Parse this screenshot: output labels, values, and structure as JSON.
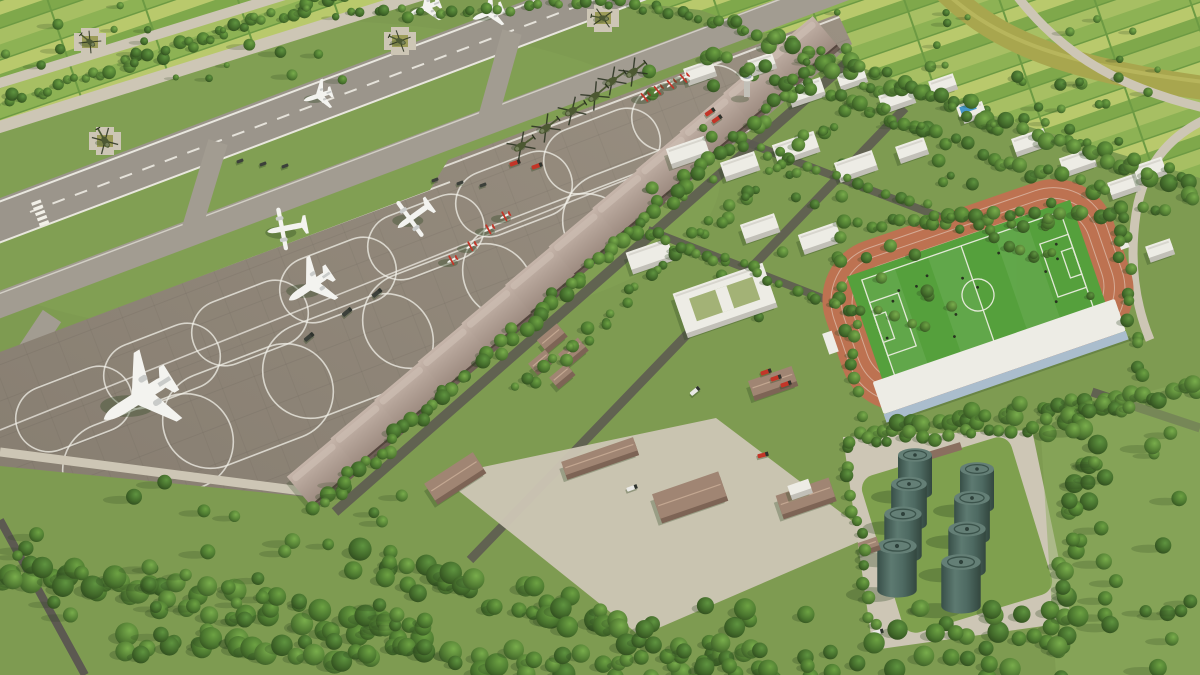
{
  "meta": {
    "description": "Aerial 3D architectural rendering of a military airbase masterplan with runway, apron, hangars, campus buildings, sports stadium and fuel tank farm",
    "visible_text": "none"
  },
  "palette": {
    "grass": "#7e9b51",
    "grass-light": "#8cab5d",
    "farm-mid": "#9ab85e",
    "farm-light": "#c6cf78",
    "farm-dark": "#6d9а43",
    "farm-dark-safe": "#6d9a43",
    "canal": "#a8a64e",
    "road-light": "#cdc6b5",
    "road-dark": "#8b867b",
    "asphalt": "#5c5951",
    "runway": "#9b958b",
    "taxiway": "#a29c91",
    "apron": "#8f8679",
    "marking": "#f2f0e8",
    "pad-olive": "#9c9c58",
    "bld-white": "#edece5",
    "bld-wall": "#c2c0b8",
    "shed-roof": "#a08573",
    "shed-dark": "#7d6455",
    "hangar-roof": "#b2a196",
    "hangar-roof-hi": "#c6b5aa",
    "hangar-face": "#6e5e55",
    "pool": "#4597c9",
    "track": "#bd7251",
    "pitch": "#55a03c",
    "stand-seats": "#aabdcd",
    "tree-dark": "#33511f",
    "tree-mid": "#47702f",
    "tree-light": "#69a041",
    "tree-shadow": "#2c4420",
    "vehicle-dark": "#3c403a",
    "vehicle-white": "#e9e9e6",
    "fire-red": "#c23528",
    "plane-white": "#f3f3ef",
    "plane-gray": "#c9cbc9",
    "heli-olive": "#4c5832",
    "rotor": "#28301e",
    "wall-brown": "#8a6f5f",
    "shadow": "#37412c"
  },
  "scene": {
    "airfield": {
      "runway": {
        "x1": -60,
        "y1": 243,
        "x2": 880,
        "y2": -110,
        "width": 42
      },
      "taxiway": {
        "x1": -60,
        "y1": 327,
        "x2": 900,
        "y2": -33,
        "width": 26
      },
      "connectors": [
        [
          218,
          142,
          192,
          228
        ],
        [
          512,
          32,
          488,
          118
        ],
        [
          52,
          316,
          28,
          352
        ]
      ],
      "apron_polygon": "0,352 430,190 448,160 838,14 852,44 318,498 0,466"
    },
    "parking_rows": [
      {
        "cx0": 690,
        "cy0": 108,
        "dx": -88,
        "dy": 43,
        "n": 8,
        "w": 120,
        "h": 66,
        "rot": -21
      },
      {
        "cx0": 648,
        "cy0": 206,
        "dx": -100,
        "dy": 50,
        "n": 6,
        "w": 176,
        "h": 96,
        "rot": -21
      }
    ],
    "aircraft": [
      {
        "type": "airliner",
        "x": 138,
        "y": 398,
        "rot": -122,
        "s": 2.7
      },
      {
        "type": "jet",
        "x": 310,
        "y": 286,
        "rot": -124,
        "s": 1.7
      },
      {
        "type": "turboprop",
        "x": 287,
        "y": 228,
        "rot": -101,
        "s": 1.55
      },
      {
        "type": "turboprop",
        "x": 414,
        "y": 216,
        "rot": -126,
        "s": 1.55
      },
      {
        "type": "jet",
        "x": 425,
        "y": 8,
        "rot": -112,
        "s": 1.1
      },
      {
        "type": "jet",
        "x": 488,
        "y": 13,
        "rot": -112,
        "s": 1.1
      },
      {
        "type": "jet",
        "x": 318,
        "y": 96,
        "rot": -108,
        "s": 1.0
      },
      {
        "type": "trainer",
        "x": 505,
        "y": 216,
        "rot": -118,
        "s": 1.0
      },
      {
        "type": "trainer",
        "x": 489,
        "y": 229,
        "rot": -118,
        "s": 1.0
      },
      {
        "type": "trainer",
        "x": 471,
        "y": 246,
        "rot": -118,
        "s": 1.0
      },
      {
        "type": "trainer",
        "x": 452,
        "y": 260,
        "rot": -118,
        "s": 1.0
      },
      {
        "type": "trainer",
        "x": 645,
        "y": 97,
        "rot": -130,
        "s": 1.0
      },
      {
        "type": "trainer",
        "x": 658,
        "y": 90,
        "rot": -130,
        "s": 1.0
      },
      {
        "type": "trainer",
        "x": 671,
        "y": 84,
        "rot": -130,
        "s": 1.0
      },
      {
        "type": "trainer",
        "x": 684,
        "y": 78,
        "rot": -130,
        "s": 1.0
      }
    ],
    "helicopters": [
      {
        "x": 633,
        "y": 72,
        "rot": -128,
        "s": 1.3
      },
      {
        "x": 612,
        "y": 81,
        "rot": -125,
        "s": 1.3
      },
      {
        "x": 595,
        "y": 96,
        "rot": -130,
        "s": 1.3
      },
      {
        "x": 572,
        "y": 111,
        "rot": -122,
        "s": 1.3
      },
      {
        "x": 546,
        "y": 128,
        "rot": -128,
        "s": 1.3
      },
      {
        "x": 521,
        "y": 146,
        "rot": -125,
        "s": 1.3
      },
      {
        "x": 105,
        "y": 141,
        "rot": 150,
        "s": 1.2,
        "pad": true
      },
      {
        "x": 400,
        "y": 41,
        "rot": 115,
        "s": 1.0,
        "pad": true
      },
      {
        "x": 603,
        "y": 18,
        "rot": 100,
        "s": 1.0,
        "pad": true
      },
      {
        "x": 90,
        "y": 42,
        "rot": 130,
        "s": 1.0,
        "pad": true
      }
    ],
    "vehicles": [
      {
        "kind": "car",
        "x": 240,
        "y": 161,
        "rot": -20
      },
      {
        "kind": "car",
        "x": 263,
        "y": 164,
        "rot": -20
      },
      {
        "kind": "car",
        "x": 285,
        "y": 166,
        "rot": -20
      },
      {
        "kind": "car",
        "x": 435,
        "y": 180,
        "rot": -20
      },
      {
        "kind": "car",
        "x": 460,
        "y": 183,
        "rot": -20
      },
      {
        "kind": "car",
        "x": 483,
        "y": 185,
        "rot": -20
      },
      {
        "kind": "truck-dark",
        "x": 377,
        "y": 293,
        "rot": -40
      },
      {
        "kind": "truck-dark",
        "x": 347,
        "y": 312,
        "rot": -40
      },
      {
        "kind": "truck-dark",
        "x": 309,
        "y": 337,
        "rot": -40
      },
      {
        "kind": "fire-truck",
        "x": 515,
        "y": 163,
        "rot": -20
      },
      {
        "kind": "fire-truck",
        "x": 537,
        "y": 166,
        "rot": -20
      },
      {
        "kind": "fire-truck",
        "x": 710,
        "y": 112,
        "rot": -35
      },
      {
        "kind": "fire-truck",
        "x": 717,
        "y": 119,
        "rot": -35
      },
      {
        "kind": "fire-truck",
        "x": 763,
        "y": 455,
        "rot": -15
      },
      {
        "kind": "fire-truck",
        "x": 766,
        "y": 372,
        "rot": -19
      },
      {
        "kind": "fire-truck",
        "x": 776,
        "y": 378,
        "rot": -19
      },
      {
        "kind": "fire-truck",
        "x": 786,
        "y": 384,
        "rot": -19
      },
      {
        "kind": "truck-white",
        "x": 695,
        "y": 391,
        "rot": -40
      },
      {
        "kind": "truck-white",
        "x": 632,
        "y": 488,
        "rot": -20
      },
      {
        "kind": "truck-white",
        "x": 878,
        "y": 632,
        "rot": -15
      }
    ],
    "hangar_row": {
      "x1": 802,
      "y1": 50,
      "x2": 322,
      "y2": 472,
      "n": 12,
      "w": 60,
      "h": 38,
      "rot": -40
    },
    "buildings_white": [
      [
        700,
        72,
        30,
        13
      ],
      [
        762,
        64,
        26,
        12
      ],
      [
        806,
        92,
        36,
        15
      ],
      [
        852,
        78,
        28,
        12
      ],
      [
        897,
        99,
        34,
        14
      ],
      [
        943,
        85,
        26,
        12
      ],
      [
        973,
        112,
        24,
        11
      ],
      [
        1030,
        142,
        34,
        14
      ],
      [
        1078,
        162,
        34,
        15
      ],
      [
        1124,
        186,
        30,
        13
      ],
      [
        1160,
        250,
        26,
        12
      ],
      [
        688,
        152,
        40,
        16
      ],
      [
        740,
        166,
        36,
        15
      ],
      [
        796,
        148,
        44,
        17
      ],
      [
        856,
        166,
        40,
        16
      ],
      [
        912,
        150,
        30,
        13
      ],
      [
        650,
        256,
        44,
        18
      ],
      [
        760,
        228,
        36,
        15
      ],
      [
        820,
        238,
        40,
        16
      ],
      [
        725,
        300,
        95,
        42,
        "hq"
      ],
      [
        1150,
        170,
        30,
        14
      ]
    ],
    "control_tower": {
      "x": 747,
      "y": 95
    },
    "pool": {
      "x": 968,
      "y": 108,
      "rot": -19
    },
    "buildings_brown": [
      {
        "x": 552,
        "y": 338,
        "w": 26,
        "h": 12,
        "rot": -40
      },
      {
        "x": 573,
        "y": 352,
        "w": 26,
        "h": 12,
        "rot": -40
      },
      {
        "x": 541,
        "y": 362,
        "w": 22,
        "h": 10,
        "rot": -40
      },
      {
        "x": 562,
        "y": 376,
        "w": 22,
        "h": 10,
        "rot": -40
      },
      {
        "x": 455,
        "y": 478,
        "w": 58,
        "h": 20,
        "rot": -33
      },
      {
        "x": 600,
        "y": 458,
        "w": 76,
        "h": 14,
        "rot": -19
      },
      {
        "x": 690,
        "y": 497,
        "w": 70,
        "h": 26,
        "rot": -19
      },
      {
        "x": 806,
        "y": 498,
        "w": 56,
        "h": 20,
        "rot": -19
      },
      {
        "x": 773,
        "y": 383,
        "w": 46,
        "h": 16,
        "rot": -19
      },
      {
        "x": 869,
        "y": 546,
        "w": 20,
        "h": 9,
        "rot": -19
      },
      {
        "x": 800,
        "y": 489,
        "w": 22,
        "h": 10,
        "rot": -19,
        "kind": "white"
      }
    ],
    "streets": [
      [
        848,
        62,
        335,
        512,
        10
      ],
      [
        905,
        108,
        470,
        560,
        9
      ],
      [
        648,
        230,
        868,
        316,
        8
      ],
      [
        704,
        126,
        1052,
        260,
        8
      ],
      [
        1092,
        392,
        1200,
        428,
        9
      ]
    ],
    "stadium": {
      "cx": 978,
      "cy": 295,
      "rot": -19,
      "track_w": 304,
      "track_h": 176,
      "pitch_w": 210,
      "pitch_h": 104,
      "players": 14
    },
    "fuel_farm": {
      "pad_polygon": "843,437 1032,430 1072,622 873,650",
      "tanks": [
        {
          "x": 915,
          "y": 455,
          "s": 1.0
        },
        {
          "x": 909,
          "y": 484,
          "s": 1.05
        },
        {
          "x": 903,
          "y": 514,
          "s": 1.1
        },
        {
          "x": 897,
          "y": 546,
          "s": 1.16
        },
        {
          "x": 977,
          "y": 469,
          "s": 1.0
        },
        {
          "x": 972,
          "y": 498,
          "s": 1.05
        },
        {
          "x": 967,
          "y": 529,
          "s": 1.1
        },
        {
          "x": 961,
          "y": 562,
          "s": 1.16
        }
      ]
    },
    "vegetation": {
      "belts": [
        {
          "name": "road-a-trees",
          "x1": 0,
          "y1": 104,
          "x2": 345,
          "y2": -6,
          "n": 40,
          "rmin": 4,
          "rmax": 7,
          "j": 6
        },
        {
          "name": "farm-edge-trees",
          "x1": 350,
          "y1": 16,
          "x2": 612,
          "y2": 2,
          "n": 22,
          "rmin": 4,
          "rmax": 6,
          "j": 5
        },
        {
          "name": "hangar-road-west",
          "x1": 842,
          "y1": 48,
          "x2": 318,
          "y2": 506,
          "n": 80,
          "rmin": 5,
          "rmax": 8,
          "j": 6
        },
        {
          "name": "hangar-road-east",
          "x1": 872,
          "y1": 86,
          "x2": 520,
          "y2": 392,
          "n": 45,
          "rmin": 4,
          "rmax": 7,
          "j": 7
        },
        {
          "name": "campus-north-belt",
          "x1": 742,
          "y1": 30,
          "x2": 1200,
          "y2": 190,
          "n": 60,
          "rmin": 5,
          "rmax": 9,
          "j": 9
        },
        {
          "name": "campus-north-belt2",
          "x1": 700,
          "y1": 52,
          "x2": 1160,
          "y2": 214,
          "n": 45,
          "rmin": 5,
          "rmax": 8,
          "j": 8
        },
        {
          "name": "canal-west-belt",
          "x1": 612,
          "y1": 0,
          "x2": 742,
          "y2": 28,
          "n": 14,
          "rmin": 4,
          "rmax": 6,
          "j": 5
        },
        {
          "name": "stadium-north",
          "x1": 846,
          "y1": 226,
          "x2": 1118,
          "y2": 212,
          "n": 26,
          "rmin": 5,
          "rmax": 8,
          "j": 7
        },
        {
          "name": "stadium-south",
          "x1": 860,
          "y1": 430,
          "x2": 1130,
          "y2": 400,
          "n": 30,
          "rmin": 6,
          "rmax": 9,
          "j": 8
        },
        {
          "name": "stadium-west",
          "x1": 836,
          "y1": 238,
          "x2": 858,
          "y2": 412,
          "n": 13,
          "rmin": 5,
          "rmax": 7,
          "j": 6
        },
        {
          "name": "stadium-east",
          "x1": 1118,
          "y1": 216,
          "x2": 1140,
          "y2": 392,
          "n": 13,
          "rmin": 5,
          "rmax": 7,
          "j": 6
        },
        {
          "name": "fuel-west",
          "x1": 846,
          "y1": 448,
          "x2": 872,
          "y2": 628,
          "n": 13,
          "rmin": 5,
          "rmax": 7,
          "j": 5
        },
        {
          "name": "fuel-north",
          "x1": 852,
          "y1": 440,
          "x2": 1036,
          "y2": 430,
          "n": 16,
          "rmin": 5,
          "rmax": 7,
          "j": 5
        },
        {
          "name": "campus-street-1",
          "x1": 648,
          "y1": 232,
          "x2": 864,
          "y2": 316,
          "n": 20,
          "rmin": 4,
          "rmax": 6,
          "j": 6
        },
        {
          "name": "campus-street-2",
          "x1": 704,
          "y1": 128,
          "x2": 1050,
          "y2": 258,
          "n": 28,
          "rmin": 4,
          "rmax": 6,
          "j": 6
        },
        {
          "name": "bottom-forest-1",
          "x1": 0,
          "y1": 568,
          "x2": 440,
          "y2": 636,
          "n": 55,
          "rmin": 7,
          "rmax": 12,
          "j": 16
        },
        {
          "name": "bottom-forest-2",
          "x1": 120,
          "y1": 640,
          "x2": 705,
          "y2": 674,
          "n": 55,
          "rmin": 7,
          "rmax": 12,
          "j": 14
        },
        {
          "name": "bottom-forest-3",
          "x1": 360,
          "y1": 560,
          "x2": 780,
          "y2": 668,
          "n": 55,
          "rmin": 7,
          "rmax": 12,
          "j": 16
        },
        {
          "name": "right-forest-edge",
          "x1": 1052,
          "y1": 672,
          "x2": 1092,
          "y2": 420,
          "n": 26,
          "rmin": 7,
          "rmax": 10,
          "j": 12
        },
        {
          "name": "right-road-belt",
          "x1": 1040,
          "y1": 428,
          "x2": 1200,
          "y2": 384,
          "n": 18,
          "rmin": 6,
          "rmax": 9,
          "j": 8
        }
      ],
      "clusters": [
        {
          "name": "tl-farm-trees",
          "x": 4,
          "y": 4,
          "w": 340,
          "h": 80,
          "n": 22,
          "rmin": 3,
          "rmax": 6,
          "shadow": "long"
        },
        {
          "name": "tr-farm-trees",
          "x": 780,
          "y": 10,
          "w": 400,
          "h": 120,
          "n": 24,
          "rmin": 3,
          "rmax": 5,
          "shadow": "long"
        },
        {
          "name": "campus-infill",
          "x": 630,
          "y": 60,
          "w": 500,
          "h": 270,
          "n": 70,
          "rmin": 4,
          "rmax": 7
        },
        {
          "name": "orchard",
          "x": 10,
          "y": 470,
          "w": 400,
          "h": 170,
          "n": 34,
          "rmin": 5,
          "rmax": 8,
          "shadow": "long"
        },
        {
          "name": "right-lawn",
          "x": 1070,
          "y": 430,
          "w": 130,
          "h": 240,
          "n": 22,
          "rmin": 5,
          "rmax": 9,
          "shadow": "long"
        },
        {
          "name": "se-forest",
          "x": 700,
          "y": 600,
          "w": 380,
          "h": 80,
          "n": 40,
          "rmin": 7,
          "rmax": 11
        }
      ]
    }
  }
}
